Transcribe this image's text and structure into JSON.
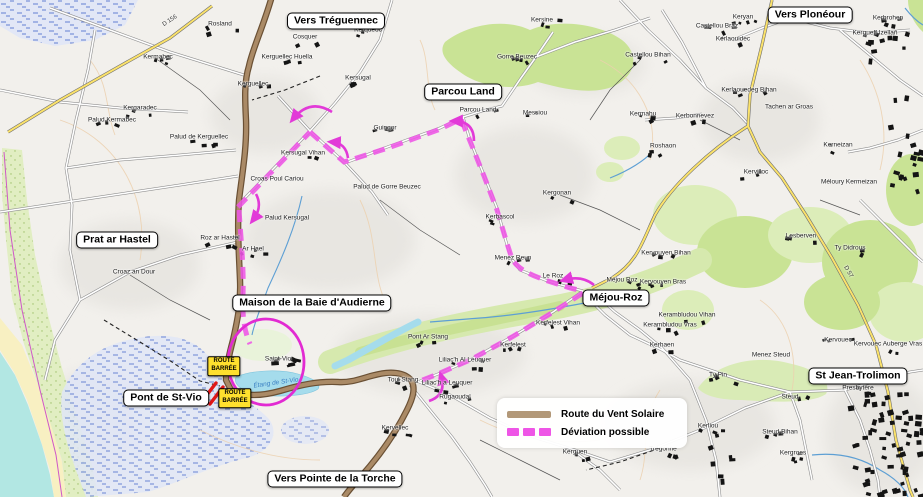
{
  "map": {
    "colors": {
      "route_brown": "#b29878",
      "route_brown_dark": "#6a5034",
      "deviation_magenta": "#ee55e6",
      "arrow_magenta": "#e23ad8",
      "closure_red": "#e01818",
      "sign_yellow": "#ffe02e",
      "water_cyan": "#a5dcec",
      "woodland_green": "#c9e395"
    },
    "legend": {
      "items": [
        {
          "label": "Route du Vent Solaire",
          "swatch": "solid"
        },
        {
          "label": "Déviation possible",
          "swatch": "dashed"
        }
      ]
    },
    "region_labels": [
      {
        "text": "Vers Tréguennec",
        "x": 336,
        "y": 21
      },
      {
        "text": "Vers Plonéour",
        "x": 810,
        "y": 15
      },
      {
        "text": "Parcou Land",
        "x": 463,
        "y": 92
      },
      {
        "text": "Prat ar Hastel",
        "x": 117,
        "y": 240
      },
      {
        "text": "Maison de la Baie d'Audierne",
        "x": 312,
        "y": 303
      },
      {
        "text": "Méjou-Roz",
        "x": 616,
        "y": 298
      },
      {
        "text": "Pont de St-Vio",
        "x": 166,
        "y": 398
      },
      {
        "text": "Vers Pointe de la Torche",
        "x": 335,
        "y": 479
      },
      {
        "text": "St Jean-Trolimon",
        "x": 858,
        "y": 376
      }
    ],
    "signs": [
      {
        "lines": [
          "ROUTE",
          "BARRÉE"
        ],
        "x": 224,
        "y": 366
      },
      {
        "lines": [
          "ROUTE",
          "BARRÉE"
        ],
        "x": 235,
        "y": 398
      }
    ],
    "water_labels": [
      {
        "name": "Étang de St-Vio",
        "x": 276,
        "y": 383
      }
    ],
    "road_labels": [
      {
        "name": "D 156",
        "x": 170,
        "y": 21,
        "angle": -33
      },
      {
        "name": "D 57",
        "x": 848,
        "y": 272,
        "angle": 60
      }
    ],
    "places": [
      {
        "name": "Rosland",
        "x": 220,
        "y": 24
      },
      {
        "name": "Cosquer",
        "x": 305,
        "y": 37
      },
      {
        "name": "Kermabec",
        "x": 158,
        "y": 57
      },
      {
        "name": "Kerguellec Huella",
        "x": 287,
        "y": 57
      },
      {
        "name": "Kerguellec",
        "x": 253,
        "y": 84
      },
      {
        "name": "Kergaradec",
        "x": 140,
        "y": 108
      },
      {
        "name": "Palud Kermabec",
        "x": 112,
        "y": 120
      },
      {
        "name": "Palud de Kerguellec",
        "x": 199,
        "y": 137
      },
      {
        "name": "Kerqueoc",
        "x": 368,
        "y": 30
      },
      {
        "name": "Kersugal",
        "x": 358,
        "y": 78
      },
      {
        "name": "Kersine",
        "x": 542,
        "y": 20
      },
      {
        "name": "Gorre Beuzec",
        "x": 517,
        "y": 57
      },
      {
        "name": "Parcou Land",
        "x": 478,
        "y": 110
      },
      {
        "name": "Messiou",
        "x": 535,
        "y": 113
      },
      {
        "name": "Guingor",
        "x": 385,
        "y": 128
      },
      {
        "name": "Kersugal Vihan",
        "x": 303,
        "y": 153
      },
      {
        "name": "Croas Poul Cariou",
        "x": 277,
        "y": 179,
        "nb": true
      },
      {
        "name": "Palud Kersugal",
        "x": 287,
        "y": 218,
        "nb": true
      },
      {
        "name": "Roz ar Hastel",
        "x": 220,
        "y": 238
      },
      {
        "name": "Ar Hael",
        "x": 253,
        "y": 249
      },
      {
        "name": "Croaz an Dour",
        "x": 134,
        "y": 272,
        "nb": true
      },
      {
        "name": "Palud de Gorre Beuzec",
        "x": 387,
        "y": 187,
        "nb": true
      },
      {
        "name": "Kergonan",
        "x": 557,
        "y": 193
      },
      {
        "name": "Kerbascol",
        "x": 500,
        "y": 217
      },
      {
        "name": "Menez Reun",
        "x": 513,
        "y": 258
      },
      {
        "name": "Le Roz",
        "x": 553,
        "y": 276
      },
      {
        "name": "Méjou Roz",
        "x": 622,
        "y": 280
      },
      {
        "name": "Keryan",
        "x": 743,
        "y": 17
      },
      {
        "name": "Castellou Braz",
        "x": 717,
        "y": 26
      },
      {
        "name": "Kerlaouidec",
        "x": 733,
        "y": 39
      },
      {
        "name": "Castellou Bihan",
        "x": 648,
        "y": 55
      },
      {
        "name": "Kerbrohen",
        "x": 888,
        "y": 18
      },
      {
        "name": "Kergueff Izellañ",
        "x": 875,
        "y": 33
      },
      {
        "name": "Kerlaouedeg Bihan",
        "x": 749,
        "y": 90
      },
      {
        "name": "Tachen ar Groas",
        "x": 789,
        "y": 107,
        "nb": true
      },
      {
        "name": "Kermahu",
        "x": 643,
        "y": 114
      },
      {
        "name": "Kerbonnevez",
        "x": 695,
        "y": 116
      },
      {
        "name": "Roshaon",
        "x": 663,
        "y": 146
      },
      {
        "name": "Kerneizan",
        "x": 838,
        "y": 145
      },
      {
        "name": "Méloury Kermeizan",
        "x": 849,
        "y": 182,
        "nb": true
      },
      {
        "name": "Kervilloc",
        "x": 756,
        "y": 172
      },
      {
        "name": "Lesberven",
        "x": 801,
        "y": 236
      },
      {
        "name": "Ty Didrous",
        "x": 850,
        "y": 248
      },
      {
        "name": "Kervouyen Bihan",
        "x": 666,
        "y": 253
      },
      {
        "name": "Kervouyen Bras",
        "x": 663,
        "y": 282
      },
      {
        "name": "Kerambludou Vihan",
        "x": 687,
        "y": 315
      },
      {
        "name": "Kerambludou Vras",
        "x": 670,
        "y": 325
      },
      {
        "name": "Kerfelest Vihan",
        "x": 558,
        "y": 323
      },
      {
        "name": "Kerfelest",
        "x": 513,
        "y": 345
      },
      {
        "name": "Pont Ar Stang",
        "x": 428,
        "y": 337
      },
      {
        "name": "Liliac'h Al Leuquer",
        "x": 465,
        "y": 360
      },
      {
        "name": "Liliac'h a Leuquer",
        "x": 447,
        "y": 383
      },
      {
        "name": "Rugaoudal",
        "x": 455,
        "y": 397
      },
      {
        "name": "Toul Stang",
        "x": 403,
        "y": 380
      },
      {
        "name": "Kervellec",
        "x": 395,
        "y": 428
      },
      {
        "name": "Kerguen",
        "x": 575,
        "y": 452
      },
      {
        "name": "Saint-Vio",
        "x": 278,
        "y": 359,
        "big": true
      },
      {
        "name": "Kerhaen",
        "x": 662,
        "y": 345
      },
      {
        "name": "Menez Steud",
        "x": 771,
        "y": 355,
        "nb": true
      },
      {
        "name": "Ty Pin",
        "x": 718,
        "y": 375
      },
      {
        "name": "Kerliou",
        "x": 708,
        "y": 426
      },
      {
        "name": "Steud",
        "x": 790,
        "y": 397
      },
      {
        "name": "Steud Bihan",
        "x": 780,
        "y": 432
      },
      {
        "name": "Kergroes",
        "x": 793,
        "y": 453
      },
      {
        "name": "Kervouec",
        "x": 838,
        "y": 340
      },
      {
        "name": "Kervouec Auberge Vras",
        "x": 888,
        "y": 344
      },
      {
        "name": "Trégonne",
        "x": 663,
        "y": 449
      },
      {
        "name": "Presbytère",
        "x": 858,
        "y": 388
      }
    ]
  }
}
